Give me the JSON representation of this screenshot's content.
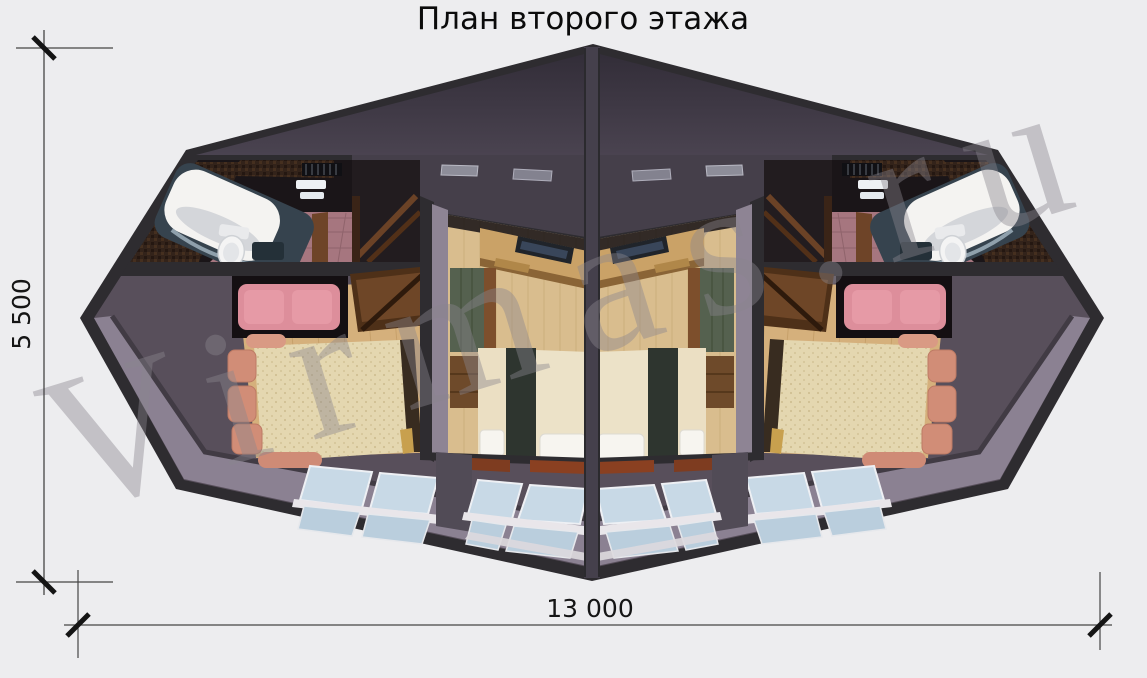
{
  "page": {
    "title": "План второго этажа"
  },
  "dimensions": {
    "vertical": {
      "label": "5 500"
    },
    "horizontal": {
      "label": "13 000"
    }
  },
  "watermark": {
    "text": "Virmas.ru"
  },
  "colors": {
    "background": "#EDEDEF",
    "walls": "#2E2C30",
    "center_wall": "#45404C",
    "ceiling_dark": "#332E39",
    "ceiling_light": "#4A4350",
    "interior_shadow": "#1A1518",
    "mosaic_wall": "#33231A",
    "bathroom_tile": "#A6767F",
    "tub_white": "#F4F3F1",
    "tub_surround": "#36434E",
    "landing_floor": "#584F5B",
    "wood_floor": "#D5B07C",
    "bedroom_floor": "#D9BD8E",
    "roof_slope": "#8B8192",
    "skylight_glass": "#C8D9E6",
    "skylight_glass_low": "#BACEDD",
    "skylight_trim": "#E9E6EA",
    "sofa_pink": "#DD8E9B",
    "bed_beige": "#E4D7B0",
    "cushion_salmon": "#D18D77",
    "wardrobe_green": "#55614F",
    "furniture_brown": "#6E4627",
    "desk_wood": "#CAA267",
    "pillow_white": "#F7F5F0",
    "threshold_brown": "#7E3C20",
    "watermark_gray": "#8A868E"
  }
}
